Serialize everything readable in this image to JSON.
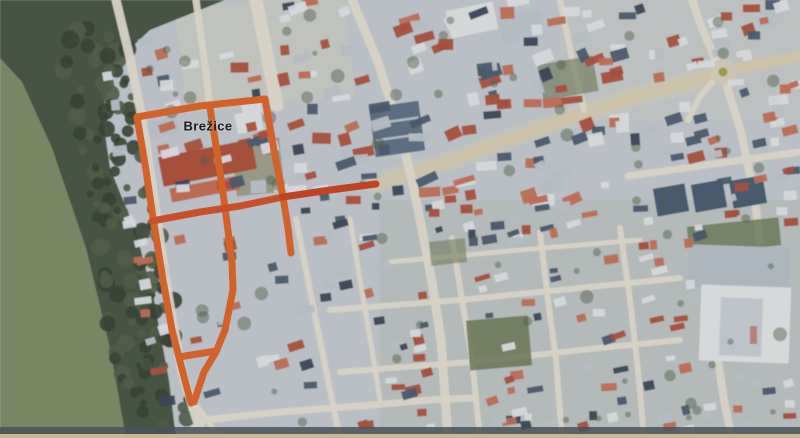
{
  "palette": {
    "urban_base": "#c7ced4",
    "urban_tint": "#d8d5c4",
    "south_tint": "#b4bab0",
    "meadow": "#7b8a60",
    "forest": "#41503a",
    "tree_dark": "#2e3b2a",
    "tree_mid": "#4a5a40",
    "road": "#eae5d6",
    "road_main": "#ddd2b2",
    "lot": "#9a9a84",
    "green_patch": "#67774f",
    "bld_white": "#e8ebee",
    "bld_lgrey": "#c2cbd3",
    "bld_red": "#b04a33",
    "bld_salmon": "#c96a50",
    "bld_slate": "#41546d",
    "bld_navy": "#2f3d52",
    "blue_hall": "#5a6d85",
    "blue_hall_stripe": "#cfd9e2",
    "hall_grey": "#b9c3cc",
    "hall_white": "#e9eced",
    "hall_court": "#ccd3d9",
    "chimney": "#c2857c",
    "route_orange": "#e4611d",
    "route_deep": "#d84b1b",
    "route_red": "#ce3a17",
    "roundabout_ring": "#ded6bd",
    "roundabout_core": "#a8a23f",
    "scan_dark": "#49525a",
    "scan_tan": "#c9b795",
    "label_color": "#1b1b1b"
  },
  "map": {
    "town_label": {
      "text": "Brežice",
      "x": 208,
      "y": 126
    },
    "roundabout": {
      "cx": 723,
      "cy": 72,
      "r": 13,
      "core_r": 4.5
    },
    "route": {
      "stroke_width": 7,
      "segments": [
        {
          "name": "route-west",
          "color": "route_orange",
          "points": [
            [
              137,
              117
            ],
            [
              146,
              170
            ],
            [
              153,
              218
            ],
            [
              163,
              280
            ],
            [
              172,
              330
            ],
            [
              183,
              373
            ],
            [
              191,
              403
            ]
          ]
        },
        {
          "name": "route-top",
          "color": "route_orange",
          "points": [
            [
              137,
              117
            ],
            [
              200,
              106
            ],
            [
              265,
              99
            ]
          ]
        },
        {
          "name": "route-east",
          "color": "route_orange",
          "points": [
            [
              265,
              99
            ],
            [
              274,
              150
            ],
            [
              283,
              197
            ],
            [
              288,
              228
            ],
            [
              291,
              253
            ]
          ]
        },
        {
          "name": "route-middle",
          "color": "route_orange",
          "points": [
            [
              210,
              108
            ],
            [
              219,
              165
            ],
            [
              226,
              215
            ],
            [
              232,
              262
            ],
            [
              233,
              290
            ],
            [
              225,
              330
            ],
            [
              216,
              352
            ],
            [
              204,
              372
            ],
            [
              194,
              402
            ]
          ]
        },
        {
          "name": "route-main-street-west",
          "color": "route_deep",
          "points": [
            [
              152,
              221
            ],
            [
              200,
              212
            ],
            [
              240,
              206
            ],
            [
              283,
              197
            ]
          ]
        },
        {
          "name": "route-main-street-east",
          "color": "route_red",
          "points": [
            [
              283,
              197
            ],
            [
              330,
              190
            ],
            [
              376,
              184
            ]
          ]
        },
        {
          "name": "route-south-rung",
          "color": "route_orange",
          "points": [
            [
              179,
              357
            ],
            [
              216,
              351
            ]
          ]
        }
      ]
    },
    "terrain": {
      "meadow_poly": [
        [
          0,
          36
        ],
        [
          60,
          52
        ],
        [
          92,
          140
        ],
        [
          118,
          260
        ],
        [
          140,
          438
        ],
        [
          0,
          438
        ]
      ],
      "forest_poly": [
        [
          0,
          0
        ],
        [
          225,
          0
        ],
        [
          150,
          30
        ],
        [
          116,
          62
        ],
        [
          102,
          112
        ],
        [
          110,
          168
        ],
        [
          136,
          232
        ],
        [
          154,
          300
        ],
        [
          169,
          380
        ],
        [
          176,
          438
        ],
        [
          126,
          438
        ],
        [
          110,
          348
        ],
        [
          86,
          248
        ],
        [
          52,
          148
        ],
        [
          22,
          82
        ],
        [
          0,
          58
        ]
      ],
      "tree_band": {
        "from": [
          88,
          30
        ],
        "to": [
          158,
          408
        ],
        "count": 120,
        "jitter": 34,
        "r_min": 3.5,
        "r_max": 9.5
      },
      "tint_patches": [
        {
          "x": 180,
          "y": 0,
          "w": 170,
          "h": 105,
          "rot": -6,
          "fill": "urban_tint",
          "alpha": 0.5
        },
        {
          "x": 560,
          "y": 0,
          "w": 240,
          "h": 120,
          "rot": 0,
          "fill": "urban_tint",
          "alpha": 0.3
        },
        {
          "x": 380,
          "y": 200,
          "w": 420,
          "h": 238,
          "rot": 0,
          "fill": "south_tint",
          "alpha": 0.35
        }
      ],
      "scan_strips": [
        {
          "x": 0,
          "y": 427,
          "w": 800,
          "h": 7,
          "fill": "scan_dark",
          "alpha": 0.85
        },
        {
          "x": 0,
          "y": 434,
          "w": 800,
          "h": 4,
          "fill": "scan_tan",
          "alpha": 1
        }
      ]
    },
    "roads": [
      {
        "name": "main-street",
        "w": 12,
        "c": "road_main",
        "halo": true,
        "points": [
          [
            376,
            184
          ],
          [
            450,
            161
          ],
          [
            540,
            128
          ],
          [
            640,
            95
          ],
          [
            705,
            78
          ],
          [
            716,
            74
          ]
        ]
      },
      {
        "name": "main-street-east",
        "w": 11,
        "c": "road_main",
        "points": [
          [
            730,
            70
          ],
          [
            800,
            56
          ]
        ]
      },
      {
        "name": "roundabout-north",
        "w": 8,
        "c": "road",
        "points": [
          [
            718,
            66
          ],
          [
            702,
            28
          ],
          [
            692,
            0
          ]
        ]
      },
      {
        "name": "roundabout-south",
        "w": 8,
        "c": "road",
        "points": [
          [
            725,
            80
          ],
          [
            741,
            132
          ],
          [
            755,
            200
          ],
          [
            762,
            262
          ],
          [
            762,
            300
          ]
        ]
      },
      {
        "name": "roundabout-southwest",
        "w": 6,
        "c": "road",
        "points": [
          [
            716,
            78
          ],
          [
            700,
            96
          ],
          [
            688,
            120
          ]
        ]
      },
      {
        "name": "north-south-street",
        "w": 9,
        "c": "road",
        "points": [
          [
            352,
            0
          ],
          [
            378,
            62
          ],
          [
            398,
            125
          ],
          [
            412,
            180
          ],
          [
            420,
            219
          ],
          [
            432,
            282
          ],
          [
            441,
            340
          ],
          [
            448,
            438
          ]
        ]
      },
      {
        "name": "west-edge-road",
        "w": 9,
        "c": "road",
        "points": [
          [
            116,
            0
          ],
          [
            130,
            58
          ],
          [
            144,
            128
          ],
          [
            157,
            219
          ],
          [
            169,
            300
          ],
          [
            182,
            372
          ],
          [
            196,
            418
          ],
          [
            205,
            438
          ]
        ]
      },
      {
        "name": "mid-north-street",
        "w": 7,
        "c": "road",
        "points": [
          [
            196,
            0
          ],
          [
            204,
            58
          ],
          [
            210,
            106
          ]
        ]
      },
      {
        "name": "top-broad-street",
        "w": 13,
        "c": "road",
        "points": [
          [
            256,
            0
          ],
          [
            267,
            55
          ],
          [
            277,
            105
          ]
        ]
      },
      {
        "name": "ne-cross-street",
        "w": 6,
        "c": "road",
        "points": [
          [
            560,
            0
          ],
          [
            572,
            58
          ],
          [
            584,
            110
          ]
        ]
      },
      {
        "name": "east-horizontal",
        "w": 7,
        "c": "road",
        "points": [
          [
            628,
            176
          ],
          [
            700,
            166
          ],
          [
            770,
            156
          ],
          [
            800,
            152
          ]
        ]
      },
      {
        "name": "south-h0",
        "w": 5,
        "c": "road",
        "points": [
          [
            390,
            262
          ],
          [
            520,
            250
          ],
          [
            640,
            240
          ]
        ]
      },
      {
        "name": "south-h1",
        "w": 6,
        "c": "road",
        "points": [
          [
            330,
            310
          ],
          [
            460,
            300
          ],
          [
            560,
            290
          ],
          [
            680,
            278
          ]
        ]
      },
      {
        "name": "south-h2",
        "w": 6,
        "c": "road",
        "points": [
          [
            340,
            372
          ],
          [
            470,
            362
          ],
          [
            600,
            348
          ],
          [
            680,
            340
          ]
        ]
      },
      {
        "name": "south-v1",
        "w": 6,
        "c": "road",
        "points": [
          [
            452,
            238
          ],
          [
            462,
            300
          ],
          [
            472,
            360
          ],
          [
            480,
            438
          ]
        ]
      },
      {
        "name": "south-v2",
        "w": 6,
        "c": "road",
        "points": [
          [
            540,
            232
          ],
          [
            548,
            300
          ],
          [
            556,
            360
          ],
          [
            562,
            438
          ]
        ]
      },
      {
        "name": "south-v3",
        "w": 6,
        "c": "road",
        "points": [
          [
            620,
            228
          ],
          [
            630,
            300
          ],
          [
            638,
            370
          ],
          [
            644,
            438
          ]
        ]
      },
      {
        "name": "oldtown-s1",
        "w": 6,
        "c": "road",
        "points": [
          [
            296,
            219
          ],
          [
            310,
            290
          ],
          [
            322,
            350
          ],
          [
            332,
            400
          ],
          [
            340,
            438
          ]
        ]
      },
      {
        "name": "oldtown-s2",
        "w": 5,
        "c": "road",
        "points": [
          [
            350,
            219
          ],
          [
            360,
            280
          ],
          [
            372,
            350
          ],
          [
            380,
            400
          ]
        ]
      },
      {
        "name": "bottom-road",
        "w": 7,
        "c": "road",
        "points": [
          [
            205,
            420
          ],
          [
            280,
            412
          ],
          [
            360,
            406
          ],
          [
            430,
            400
          ],
          [
            472,
            398
          ]
        ]
      },
      {
        "name": "y-left",
        "w": 6,
        "c": "road",
        "points": [
          [
            205,
            420
          ],
          [
            180,
            438
          ]
        ]
      },
      {
        "name": "y-down",
        "w": 6,
        "c": "road",
        "points": [
          [
            198,
            408
          ],
          [
            210,
            424
          ],
          [
            218,
            438
          ]
        ]
      },
      {
        "name": "hall-apron",
        "w": 8,
        "c": "road",
        "points": [
          [
            718,
            360
          ],
          [
            724,
            400
          ],
          [
            730,
            430
          ]
        ]
      }
    ],
    "green_patches": [
      {
        "x": 468,
        "y": 318,
        "w": 62,
        "h": 50,
        "rot": -5,
        "fill": "green_patch",
        "alpha": 0.85
      },
      {
        "x": 688,
        "y": 222,
        "w": 92,
        "h": 28,
        "rot": -6,
        "fill": "green_patch",
        "alpha": 0.8
      },
      {
        "x": 540,
        "y": 60,
        "w": 56,
        "h": 36,
        "rot": -10,
        "fill": "green_patch",
        "alpha": 0.6
      },
      {
        "x": 234,
        "y": 140,
        "w": 48,
        "h": 54,
        "rot": -6,
        "fill": "lot",
        "alpha": 0.9
      },
      {
        "x": 430,
        "y": 240,
        "w": 36,
        "h": 24,
        "rot": -6,
        "fill": "green_patch",
        "alpha": 0.55
      }
    ],
    "landmarks": [
      {
        "name": "blue-industrial-hall",
        "x": 372,
        "y": 104,
        "w": 50,
        "h": 50,
        "rot": -8,
        "fill": "blue_hall",
        "stripes": 2
      },
      {
        "name": "sports-hall-roof",
        "x": 688,
        "y": 246,
        "w": 102,
        "h": 42,
        "rot": 2,
        "fill": "hall_grey"
      },
      {
        "name": "sports-hall-main",
        "x": 700,
        "y": 286,
        "w": 90,
        "h": 76,
        "rot": 2,
        "fill": "hall_white"
      },
      {
        "name": "sports-hall-courtyard",
        "x": 720,
        "y": 298,
        "w": 42,
        "h": 58,
        "rot": 2,
        "fill": "hall_court"
      },
      {
        "name": "sports-hall-chimney",
        "x": 750,
        "y": 326,
        "w": 7,
        "h": 18,
        "rot": 0,
        "fill": "chimney"
      },
      {
        "name": "oldtown-red-complex",
        "x": 160,
        "y": 148,
        "w": 95,
        "h": 30,
        "rot": -11,
        "fill": "bld_red"
      },
      {
        "name": "oldtown-red-annex",
        "x": 170,
        "y": 182,
        "w": 70,
        "h": 14,
        "rot": -11,
        "fill": "bld_salmon"
      },
      {
        "name": "apartment-block-1",
        "x": 655,
        "y": 186,
        "w": 32,
        "h": 28,
        "rot": -10,
        "fill": "bld_slate"
      },
      {
        "name": "apartment-block-2",
        "x": 693,
        "y": 182,
        "w": 32,
        "h": 28,
        "rot": -10,
        "fill": "bld_slate"
      },
      {
        "name": "apartment-block-3",
        "x": 731,
        "y": 178,
        "w": 34,
        "h": 28,
        "rot": -10,
        "fill": "bld_slate"
      },
      {
        "name": "north-white-roof",
        "x": 448,
        "y": 6,
        "w": 48,
        "h": 28,
        "rot": -12,
        "fill": "bld_white"
      },
      {
        "name": "north-grey-roof",
        "x": 500,
        "y": 14,
        "w": 42,
        "h": 26,
        "rot": -12,
        "fill": "bld_lgrey"
      },
      {
        "name": "grid-white-building",
        "x": 236,
        "y": 112,
        "w": 26,
        "h": 20,
        "rot": -10,
        "fill": "bld_white"
      },
      {
        "name": "grid-grey-building",
        "x": 148,
        "y": 120,
        "w": 30,
        "h": 16,
        "rot": -11,
        "fill": "bld_lgrey"
      }
    ],
    "building_regions": [
      {
        "name": "north-center",
        "x": 230,
        "y": 0,
        "w": 430,
        "h": 205,
        "count": 150,
        "min": 8,
        "max": 22,
        "rot": -12,
        "jit": 14
      },
      {
        "name": "northeast",
        "x": 660,
        "y": 0,
        "w": 140,
        "h": 165,
        "count": 48,
        "min": 8,
        "max": 18,
        "rot": -10,
        "jit": 12
      },
      {
        "name": "old-town",
        "x": 95,
        "y": 40,
        "w": 215,
        "h": 390,
        "count": 70,
        "min": 8,
        "max": 18,
        "rot": -11,
        "jit": 8,
        "clip_forest": true
      },
      {
        "name": "south-residential",
        "x": 300,
        "y": 205,
        "w": 400,
        "h": 225,
        "count": 180,
        "min": 7,
        "max": 16,
        "rot": -10,
        "jit": 10
      },
      {
        "name": "east-mid",
        "x": 700,
        "y": 80,
        "w": 100,
        "h": 150,
        "count": 30,
        "min": 8,
        "max": 16,
        "rot": -8,
        "jit": 10
      },
      {
        "name": "southeast-corner",
        "x": 700,
        "y": 370,
        "w": 100,
        "h": 60,
        "count": 12,
        "min": 8,
        "max": 14,
        "rot": -8,
        "jit": 10
      }
    ],
    "scatter": {
      "seed": 20240517,
      "shrub_count": 95,
      "roof_weights": [
        [
          "bld_white",
          0.26
        ],
        [
          "bld_lgrey",
          0.16
        ],
        [
          "bld_red",
          0.22
        ],
        [
          "bld_salmon",
          0.12
        ],
        [
          "bld_slate",
          0.18
        ],
        [
          "bld_navy",
          0.06
        ]
      ]
    }
  }
}
